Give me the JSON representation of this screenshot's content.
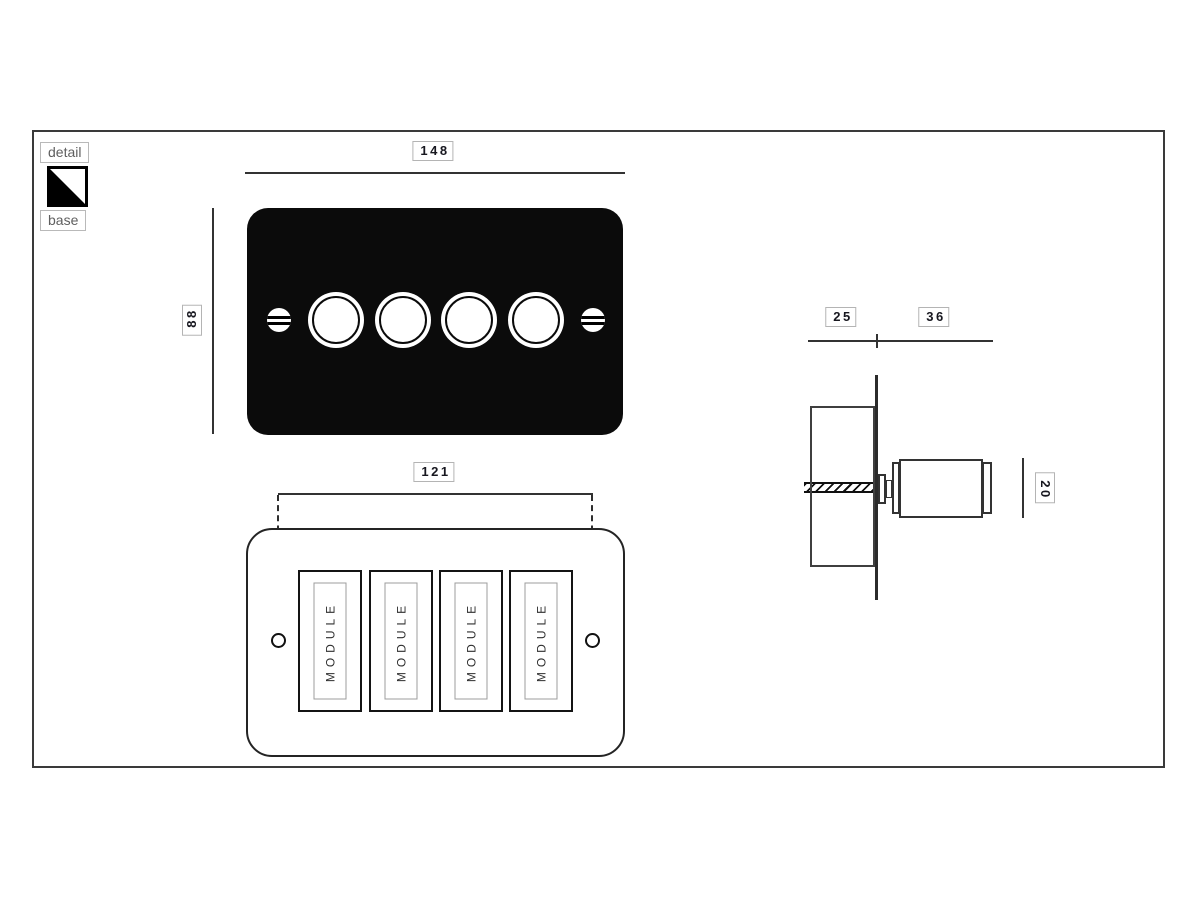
{
  "drawing": {
    "colors": {
      "plate_black": "#0b0b0b",
      "line": "#333333",
      "dim_label_border": "#b4b4b4",
      "dim_label_text": "#17171f",
      "legend_text": "#5f5f5f"
    },
    "legend": {
      "detail_label": "detail",
      "base_label": "base",
      "swatch_icon": "detail-base-finish-swatch"
    },
    "front_view": {
      "width_mm": "148",
      "height_mm": "88",
      "knob_count": 4,
      "screw_count": 2
    },
    "rear_view": {
      "hole_spacing_mm": "121",
      "modules": [
        {
          "label": "MODULE"
        },
        {
          "label": "MODULE"
        },
        {
          "label": "MODULE"
        },
        {
          "label": "MODULE"
        }
      ]
    },
    "side_view": {
      "depth_behind_mm": "25",
      "projection_mm": "36",
      "knob_diameter_mm": "20"
    }
  }
}
